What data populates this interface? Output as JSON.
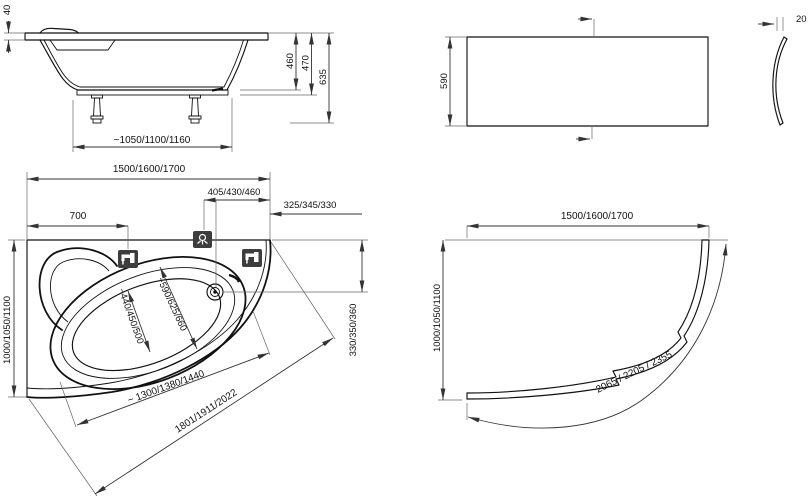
{
  "side_view": {
    "rim_thickness": "40",
    "depth": "460",
    "rim_height": "470",
    "total_height": "635",
    "feet_span": "~1050/1100/1160"
  },
  "front_panel": {
    "height": "590",
    "thickness": "20"
  },
  "plan_view": {
    "overall_length": "1500/1600/1700",
    "tap_offset": "700",
    "mixer_to_corner": "405/430/460",
    "corner_offset": "325/345/330",
    "overall_width": "1000/1050/1100",
    "drain_to_wall": "330/350/360",
    "inner_width_head": "~440/450/500",
    "inner_width_foot": "~590/625/660",
    "inner_length": "~ 1300/1380/1440",
    "front_edge_length": "1801/1911/2022"
  },
  "corner_panel": {
    "length": "1500/1600/1700",
    "width": "1000/1050/1100",
    "arc_length": "2065 / 2205 / 2355"
  }
}
